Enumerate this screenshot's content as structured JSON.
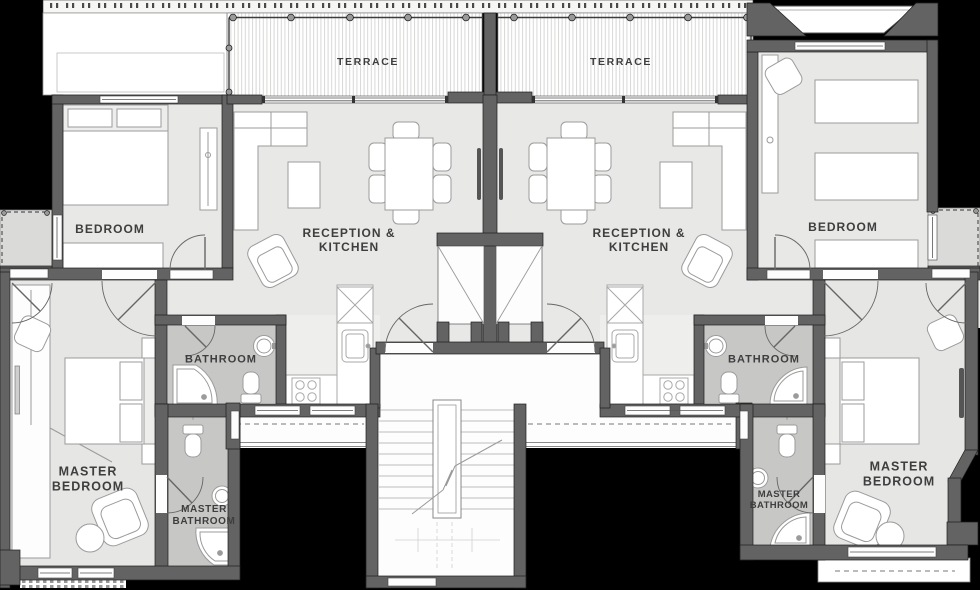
{
  "diagram_type": "architectural-floor-plan",
  "units": [
    "left-apartment",
    "right-apartment"
  ],
  "rooms": [
    {
      "id": "terrace-left",
      "label": "TERRACE"
    },
    {
      "id": "terrace-right",
      "label": "TERRACE"
    },
    {
      "id": "bedroom-left",
      "label": "BEDROOM"
    },
    {
      "id": "bedroom-right",
      "label": "BEDROOM"
    },
    {
      "id": "reception-kitchen-left",
      "label": "RECEPTION &\nKITCHEN"
    },
    {
      "id": "reception-kitchen-right",
      "label": "RECEPTION &\nKITCHEN"
    },
    {
      "id": "bathroom-left",
      "label": "BATHROOM"
    },
    {
      "id": "bathroom-right",
      "label": "BATHROOM"
    },
    {
      "id": "master-bedroom-left",
      "label": "MASTER\nBEDROOM"
    },
    {
      "id": "master-bedroom-right",
      "label": "MASTER\nBEDROOM"
    },
    {
      "id": "master-bathroom-left",
      "label": "MASTER\nBATHROOM"
    },
    {
      "id": "master-bathroom-right",
      "label": "MASTER\nBATHROOM"
    }
  ],
  "colors": {
    "background": "#000000",
    "wall": "#636363",
    "floor": "#e8e8e7",
    "bathroom_floor": "#c7c7c6",
    "outdoor_deck": "#ffffff",
    "balcony": "#dadad9",
    "label_text": "#3e3e3e",
    "furniture_outline": "#9b9b9b"
  }
}
